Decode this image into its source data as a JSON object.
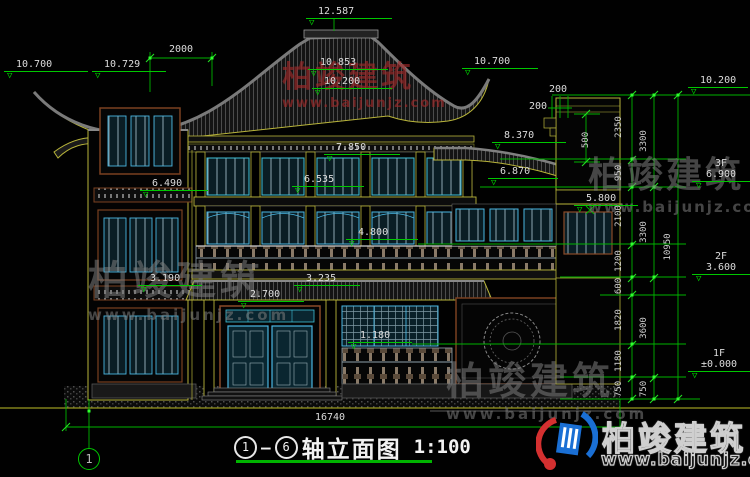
{
  "title_block": {
    "axis_start": "1",
    "axis_end": "6",
    "separator": "—",
    "name": "轴立面图",
    "scale": "1:100"
  },
  "axis_bubble_left": "1",
  "elevations": {
    "ridge": "12.587",
    "left_eave": "10.700",
    "left_eave_inner": "10.729",
    "center_upper": "10.853",
    "center_lower": "10.200",
    "right_eave": "10.700",
    "right_parapet": "10.200",
    "wing_roof": "8.370",
    "wing_roof_low": "6.870",
    "right_wall": "5.800",
    "balcony_3f": "7.850",
    "beam_3f": "6.535",
    "balcony_2f": "4.800",
    "beam_2f": "3.235",
    "porch": "2.700",
    "rail_1f": "1.180",
    "tower_upper": "6.490",
    "tower_lower": "3.190"
  },
  "floor_levels": [
    {
      "floor": "3F",
      "value": "6.900"
    },
    {
      "floor": "2F",
      "value": "3.600"
    },
    {
      "floor": "1F",
      "value": "±0.000"
    }
  ],
  "dim_chains": {
    "top_offset": "2000",
    "parapet_detail": [
      "200",
      "200",
      "500"
    ],
    "inner": [
      "2350",
      "950",
      "2100",
      "1200",
      "600",
      "1820",
      "1180",
      "750"
    ],
    "middle": [
      "3300",
      "3300",
      "3600",
      "750"
    ],
    "overall_height": "10950",
    "overall_width": "16740"
  },
  "watermark": {
    "name": "柏竣建筑",
    "url": "www.baijunjz.com"
  },
  "icons": {
    "level_marker": "▽"
  },
  "colors": {
    "dim_green": "#00c800",
    "line_yellow": "#b8b43a",
    "frame_cyan": "#49b6e2",
    "accent_brown": "#8a4a28",
    "text": "#dcdcdc",
    "logo_blue": "#1a6fd4",
    "logo_red": "#d43030"
  }
}
